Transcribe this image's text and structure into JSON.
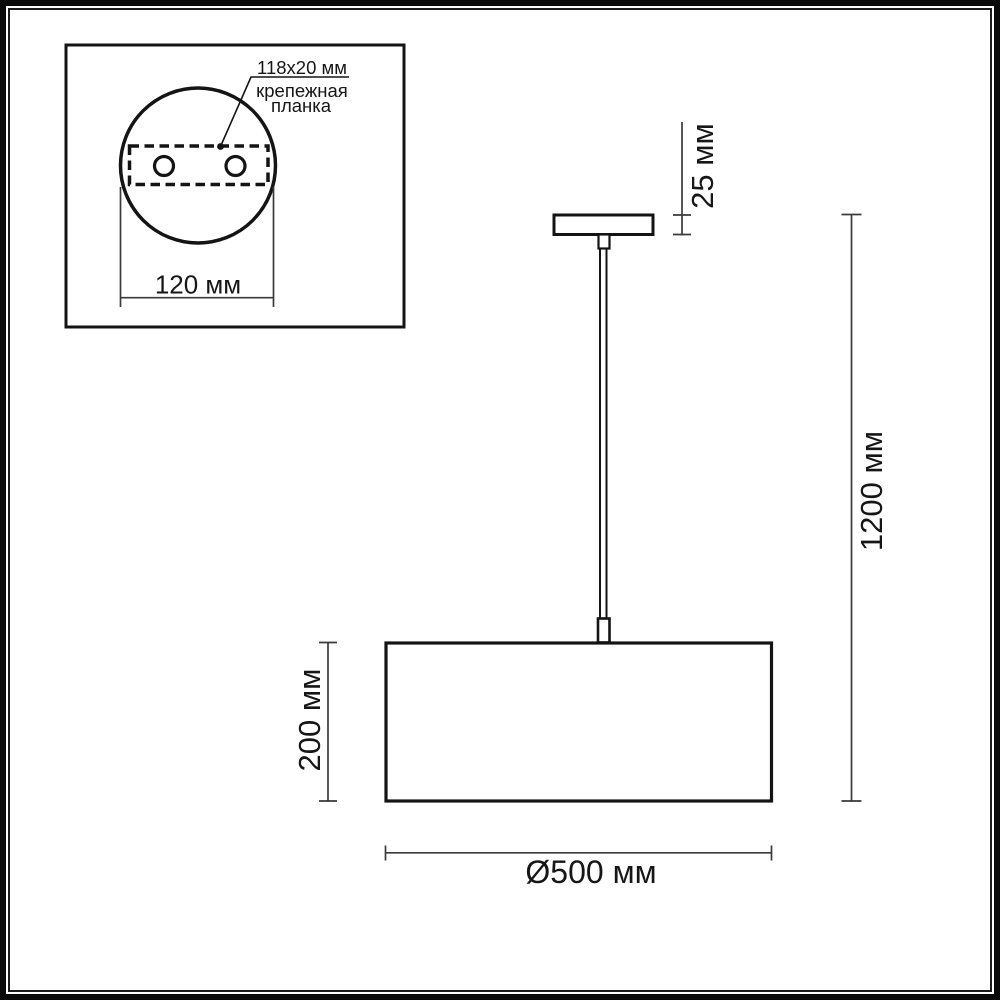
{
  "colors": {
    "line": "#141414",
    "dimension": "#3a3a3a",
    "background": "#ffffff"
  },
  "inset": {
    "plate_size_label": "118x20 мм",
    "plate_name_line1": "крепежная",
    "plate_name_line2": "планка",
    "canopy_diameter_label": "120 мм"
  },
  "side_view": {
    "canopy_height_label": "25 мм",
    "overall_height_label": "1200 мм",
    "shade_height_label": "200 мм",
    "shade_diameter_label": "Ø500 мм"
  }
}
